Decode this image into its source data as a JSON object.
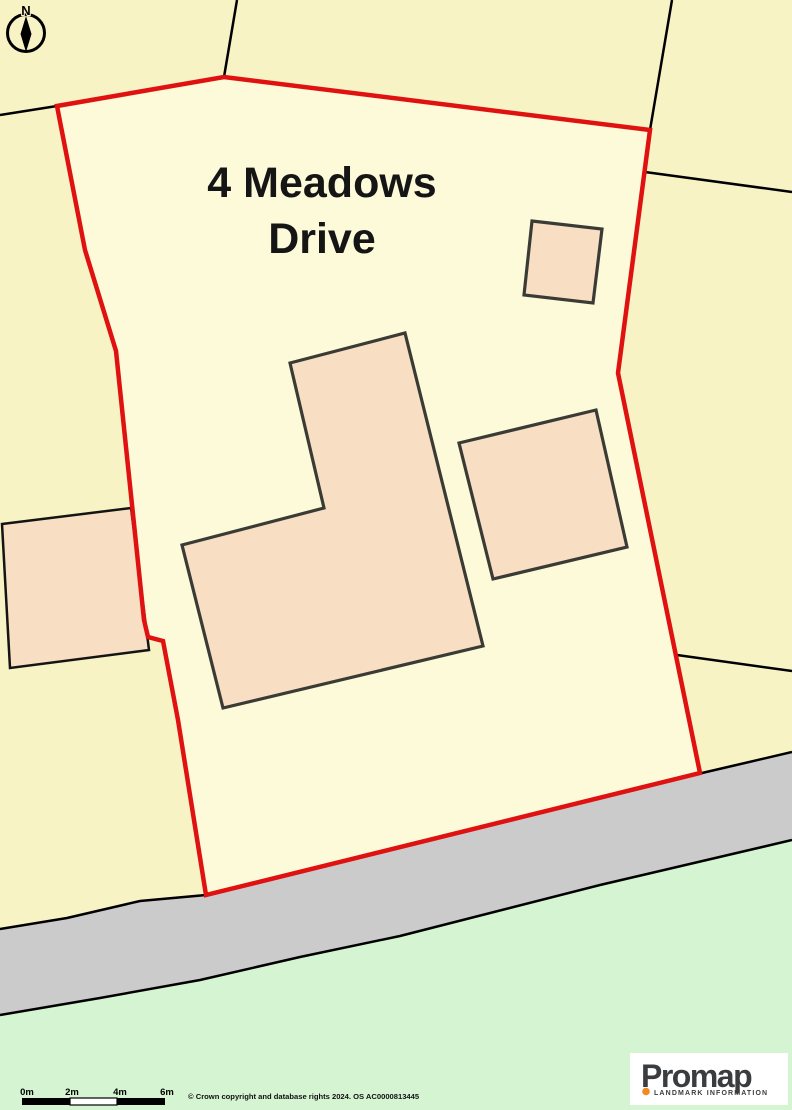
{
  "map": {
    "title_line1": "4 Meadows",
    "title_line2": "Drive",
    "compass_label": "N",
    "features": {
      "site_boundary": "red outline around 4 Meadows Drive plot",
      "buildings": [
        "main-house-l-shape",
        "outbuilding-right",
        "outbuilding-top-right",
        "neighbour-building-left"
      ],
      "road": "grey road band along bottom",
      "field": "green area below road"
    }
  },
  "scale_bar": {
    "labels": [
      "0m",
      "2m",
      "4m",
      "6m"
    ]
  },
  "attribution": "© Crown copyright and database rights 2024. OS AC0000813445",
  "logo": {
    "brand": "Promap",
    "tagline": "LANDMARK INFORMATION"
  },
  "colors": {
    "site_boundary_red": "#E01111",
    "parcel_yellow_outside": "#F8F3C5",
    "parcel_yellow_site": "#FCFAD9",
    "building_fill": "#F8DFC3",
    "building_stroke": "#3B3B36",
    "road_fill": "#CBCBCB",
    "green_fill": "#D5F4D2",
    "line_black": "#000000",
    "logo_orange": "#F28A1E",
    "logo_text": "#3A3D40"
  }
}
